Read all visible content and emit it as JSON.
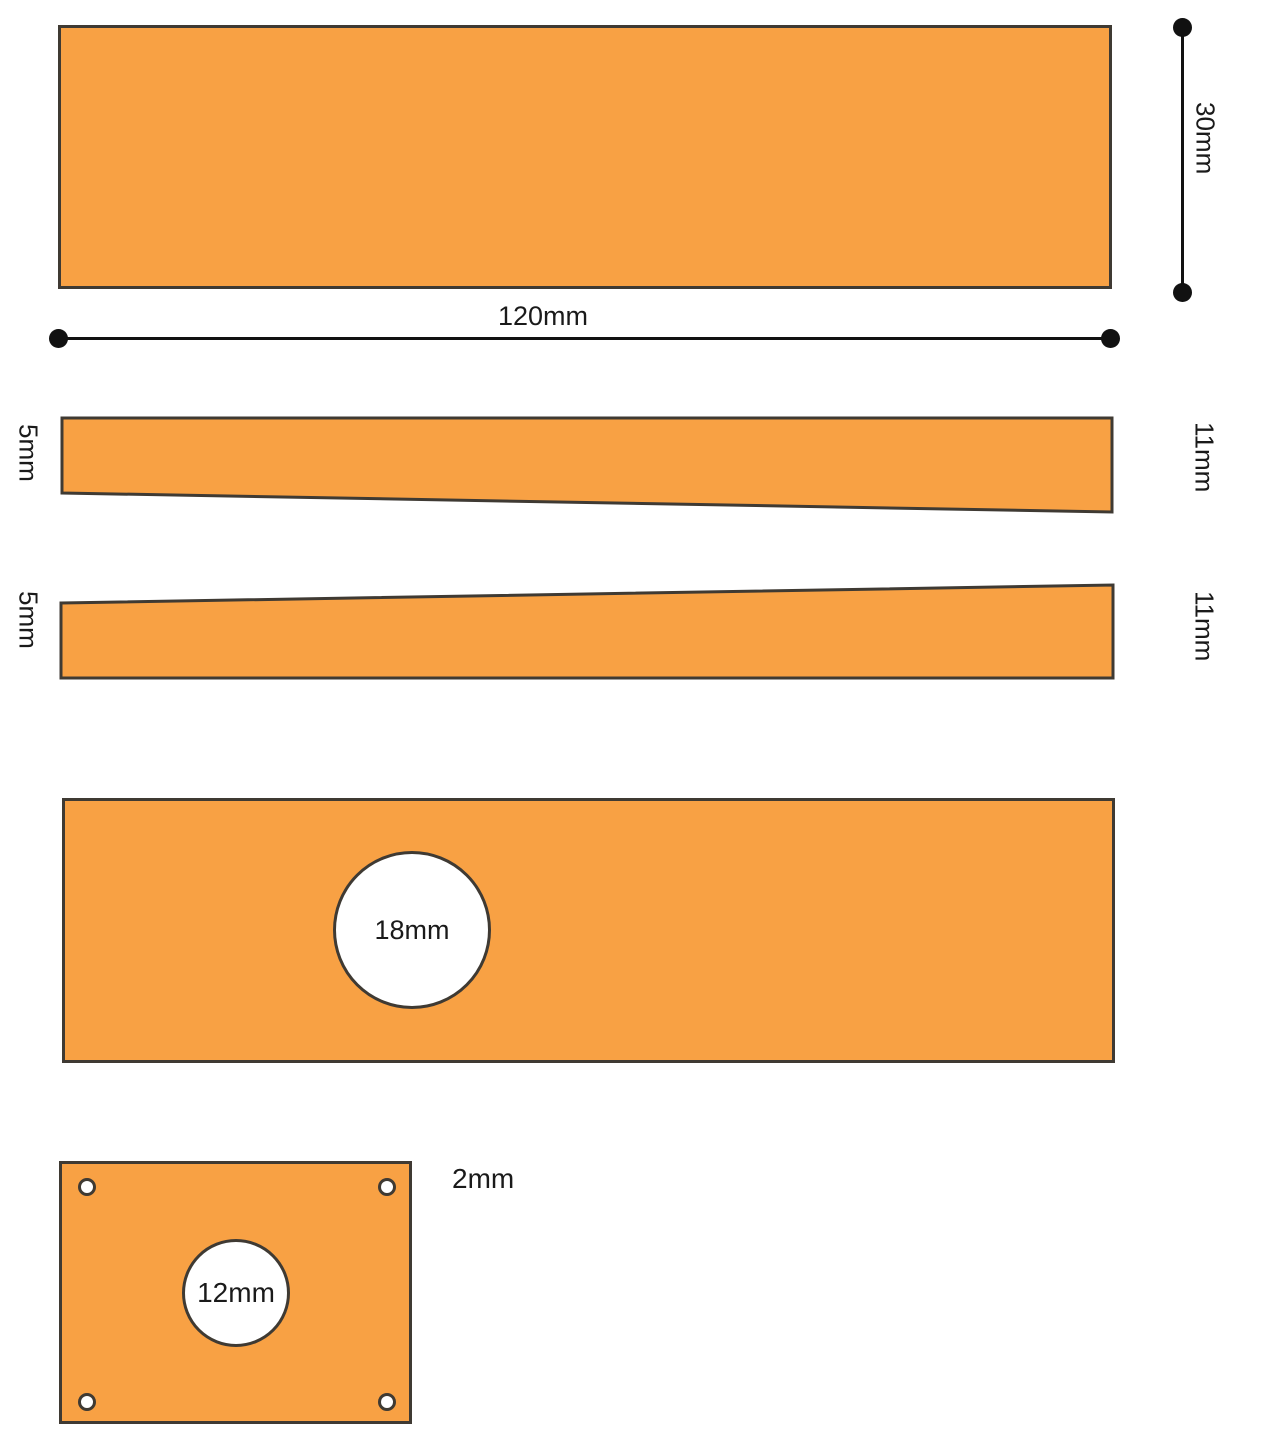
{
  "colors": {
    "part_fill": "#F8A144",
    "part_outline": "#3F3A33",
    "dimension_color": "#111111",
    "hole_fill": "#FFFFFF",
    "text_color": "#1A1A1A",
    "background": "#FFFFFF"
  },
  "top_plate": {
    "width_label": "120mm",
    "height_label": "30mm"
  },
  "taper_strip_1": {
    "left_label": "5mm",
    "right_label": "11mm"
  },
  "taper_strip_2": {
    "left_label": "5mm",
    "right_label": "11mm"
  },
  "hole_plate": {
    "hole_label": "18mm"
  },
  "base_plate": {
    "hole_label": "12mm",
    "corner_hole_label": "2mm"
  }
}
